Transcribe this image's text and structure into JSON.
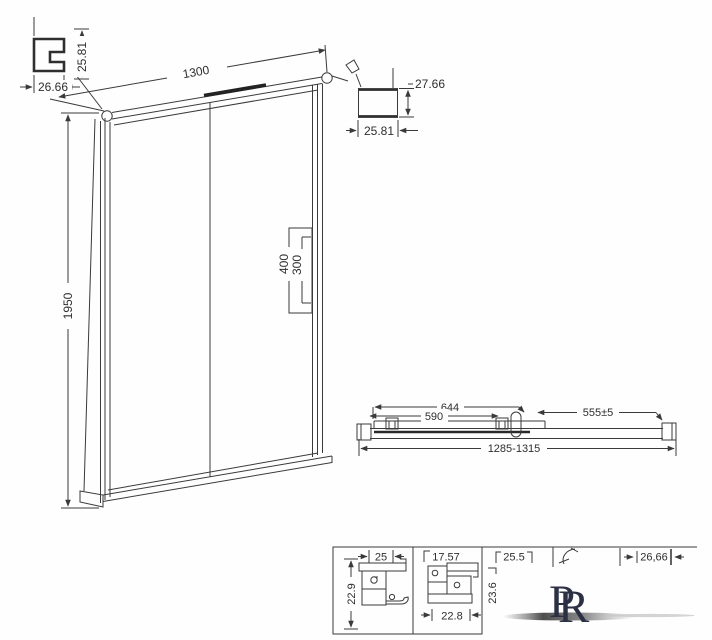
{
  "detail_top_left": {
    "width": "26.66",
    "height": "25.81"
  },
  "detail_top_right": {
    "height": "27.66",
    "width": "25.81"
  },
  "elevation": {
    "width": "1300",
    "height": "1950",
    "handle_plate_height": "400",
    "handle_grip_height": "300"
  },
  "plan": {
    "panel_width": "644",
    "glass_width": "590",
    "side_section": "555±5",
    "overall_range": "1285-1315"
  },
  "sections": {
    "s1_width": "25",
    "s1_height": "22.9",
    "s2_width": "17.57",
    "s2_bottom_width": "22.8",
    "s3_width": "25.5",
    "s3_height": "23.6",
    "s4_width": "26,66"
  },
  "logo": {
    "letter_p": "P",
    "letter_r": "R"
  },
  "colors": {
    "line": "#3a3a3a",
    "text": "#2e2e2e",
    "logo": "#2b3044"
  }
}
